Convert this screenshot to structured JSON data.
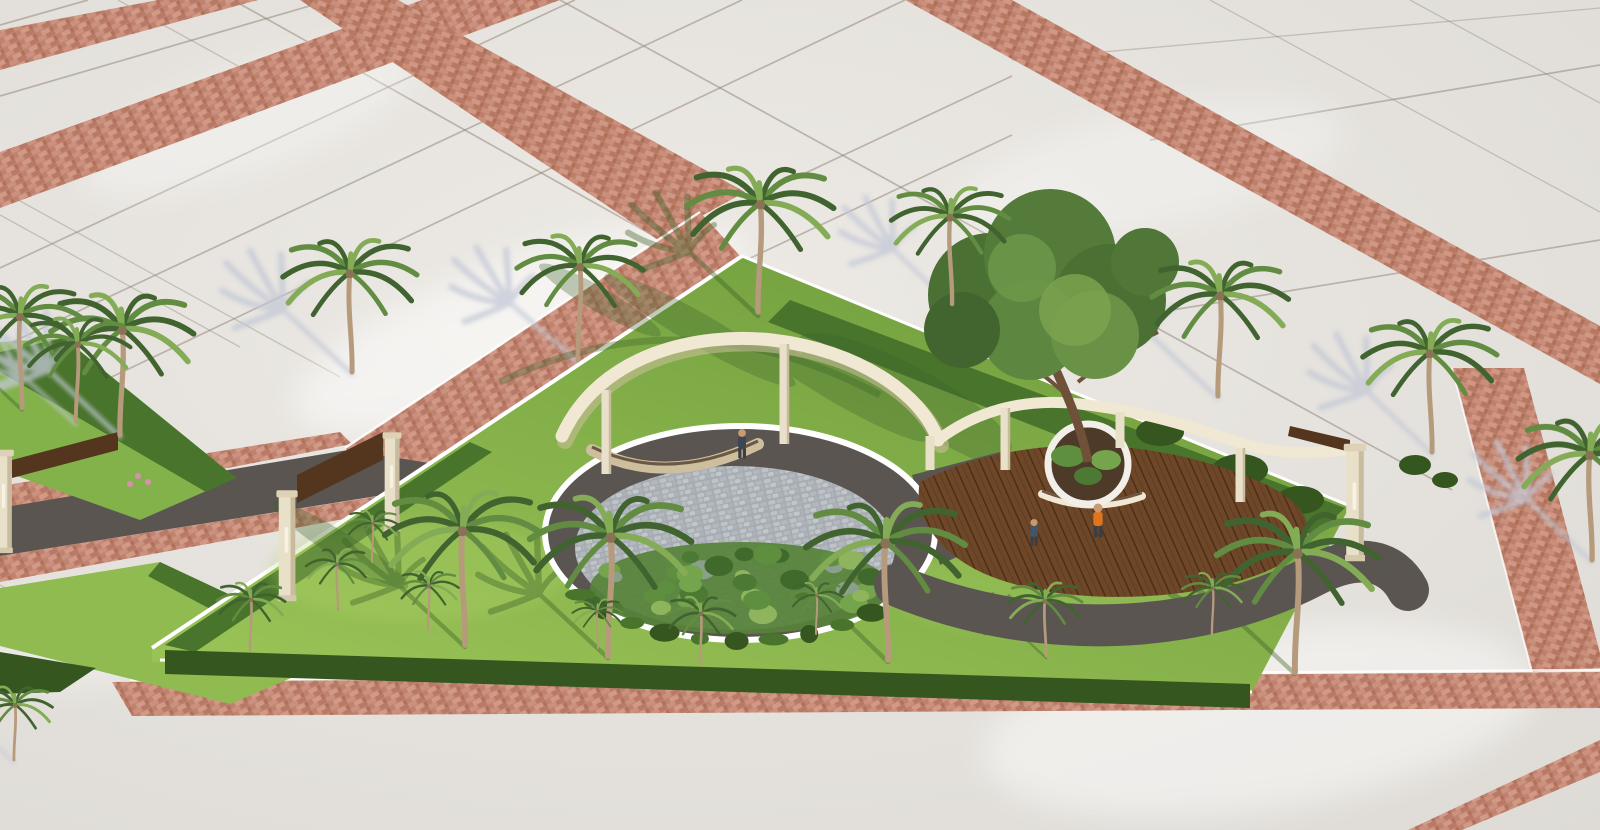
{
  "meta": {
    "description": "Aerial 3D architectural rendering of a triangular pocket park with palm trees, a circular cobblestone plaza under a curved cream pergola, a curved wooden deck with a round tree planter, entrance gates with wooden beams, lawns and hedges, surrounded by large light concrete paving with terracotta brick walkway bands"
  },
  "colors": {
    "pavement": "#e7e4df",
    "pavementEdge": "#dedbd6",
    "tileLine": "#8d8173",
    "brick": "#c28572",
    "brickDark": "#a96853",
    "brickLight": "#d9a38e",
    "white": "#ffffff",
    "curb": "#f7f5f0",
    "lawnLight": "#9fc95c",
    "lawn": "#7fae45",
    "lawnDark": "#5d8a33",
    "hedge": "#49742c",
    "hedgeDark": "#35571f",
    "asphalt": "#5b5551",
    "cobble": "#abb1b6",
    "bed": "#57823a",
    "deck": "#6e4728",
    "deckLine": "#4a2d16",
    "pergola": "#f0e8d2",
    "pergolaShade": "#cdbf9e",
    "beam": "#54361e",
    "trunk": "#b69a7c",
    "trunkDark": "#8a7257",
    "frondDark": "#41632f",
    "frondMid": "#628c41",
    "frondLight": "#84ab55",
    "shadowPave": "#c3c8d6",
    "shadowLawn": "#3c612a",
    "skin": "#c79a72",
    "legs": "#3a3f46",
    "personOrange": "#e0751f",
    "personDark": "#3d4754",
    "personBlue": "#41566b",
    "flower": "#d88fb0"
  },
  "palms": [
    {
      "x": 120,
      "y": 435,
      "s": 1.15,
      "flip": false
    },
    {
      "x": 352,
      "y": 372,
      "s": 1.08,
      "flip": true
    },
    {
      "x": 578,
      "y": 360,
      "s": 1.02,
      "flip": false
    },
    {
      "x": 758,
      "y": 312,
      "s": 1.18,
      "flip": false
    },
    {
      "x": 952,
      "y": 304,
      "s": 0.95,
      "flip": true
    },
    {
      "x": 1218,
      "y": 396,
      "s": 1.1,
      "flip": false
    },
    {
      "x": 1432,
      "y": 452,
      "s": 1.08,
      "flip": true
    },
    {
      "x": 22,
      "y": 408,
      "s": 1.0,
      "flip": true
    },
    {
      "x": 76,
      "y": 422,
      "s": 0.85,
      "flip": false
    },
    {
      "x": 465,
      "y": 645,
      "s": 1.25,
      "flip": true
    },
    {
      "x": 608,
      "y": 656,
      "s": 1.3,
      "flip": false
    },
    {
      "x": 888,
      "y": 660,
      "s": 1.28,
      "flip": true
    },
    {
      "x": 1295,
      "y": 672,
      "s": 1.3,
      "flip": false
    },
    {
      "x": 250,
      "y": 650,
      "s": 0.55,
      "flip": false
    },
    {
      "x": 338,
      "y": 610,
      "s": 0.5,
      "flip": true
    },
    {
      "x": 428,
      "y": 630,
      "s": 0.48,
      "flip": false
    },
    {
      "x": 372,
      "y": 562,
      "s": 0.42,
      "flip": false
    },
    {
      "x": 700,
      "y": 664,
      "s": 0.55,
      "flip": false
    },
    {
      "x": 598,
      "y": 648,
      "s": 0.4,
      "flip": true
    },
    {
      "x": 816,
      "y": 634,
      "s": 0.42,
      "flip": false
    },
    {
      "x": 1046,
      "y": 656,
      "s": 0.6,
      "flip": true
    },
    {
      "x": 1212,
      "y": 634,
      "s": 0.5,
      "flip": false
    },
    {
      "x": 1592,
      "y": 560,
      "s": 1.15,
      "flip": true
    },
    {
      "x": 14,
      "y": 760,
      "s": 0.6,
      "flip": false
    }
  ],
  "pavement_shadows": [
    {
      "x": 120,
      "y": 437,
      "rot": -137,
      "s": 1.2
    },
    {
      "x": 352,
      "y": 374,
      "rot": -137,
      "s": 1.15
    },
    {
      "x": 578,
      "y": 362,
      "rot": -139,
      "s": 1.1
    },
    {
      "x": 952,
      "y": 306,
      "rot": -136,
      "s": 1.0
    },
    {
      "x": 1218,
      "y": 398,
      "rot": -137,
      "s": 1.15
    },
    {
      "x": 1432,
      "y": 454,
      "rot": -136,
      "s": 1.1
    },
    {
      "x": 76,
      "y": 424,
      "rot": -138,
      "s": 0.9
    },
    {
      "x": 1592,
      "y": 562,
      "rot": -136,
      "s": 1.1
    },
    {
      "x": 14,
      "y": 762,
      "rot": -137,
      "s": 0.7
    }
  ],
  "lawn_palm_shadows": [
    {
      "x": 758,
      "y": 316,
      "rot": -137,
      "s": 1.15
    },
    {
      "x": 465,
      "y": 647,
      "rot": -137,
      "s": 1.1
    },
    {
      "x": 608,
      "y": 658,
      "rot": -137,
      "s": 1.15
    },
    {
      "x": 888,
      "y": 662,
      "rot": -136,
      "s": 1.1
    },
    {
      "x": 1295,
      "y": 674,
      "rot": -137,
      "s": 1.1
    },
    {
      "x": 1046,
      "y": 658,
      "rot": -137,
      "s": 0.6
    },
    {
      "x": 22,
      "y": 410,
      "rot": -137,
      "s": 0.85
    }
  ],
  "lawn_streaks": [
    {
      "cx": 700,
      "cy": 330,
      "rx": 110,
      "ry": 16,
      "rot": 30
    },
    {
      "cx": 840,
      "cy": 390,
      "rx": 100,
      "ry": 14,
      "rot": 30
    },
    {
      "cx": 600,
      "cy": 300,
      "rx": 70,
      "ry": 12,
      "rot": 30
    },
    {
      "cx": 950,
      "cy": 432,
      "rx": 90,
      "ry": 14,
      "rot": 28
    },
    {
      "cx": 905,
      "cy": 395,
      "rx": 120,
      "ry": 30,
      "rot": 28
    },
    {
      "cx": 340,
      "cy": 545,
      "rx": 80,
      "ry": 13,
      "rot": 32
    },
    {
      "cx": 1140,
      "cy": 500,
      "rx": 80,
      "ry": 12,
      "rot": 28
    }
  ],
  "people": [
    {
      "x": 742,
      "y": 452,
      "shirt": "#3d4754",
      "s": 1.25
    },
    {
      "x": 1098,
      "y": 530,
      "shirt": "#e0751f",
      "s": 1.45
    },
    {
      "x": 1034,
      "y": 540,
      "shirt": "#41566b",
      "s": 1.15
    }
  ],
  "bed": {
    "count": 34,
    "colors": [
      "#3f6a2c",
      "#5d8f3f",
      "#74a44c",
      "#8fb45e",
      "#8aa08c",
      "#4c7a35"
    ]
  },
  "flowers": [
    {
      "x": 138,
      "y": 476
    },
    {
      "x": 148,
      "y": 482
    },
    {
      "x": 130,
      "y": 484
    }
  ]
}
